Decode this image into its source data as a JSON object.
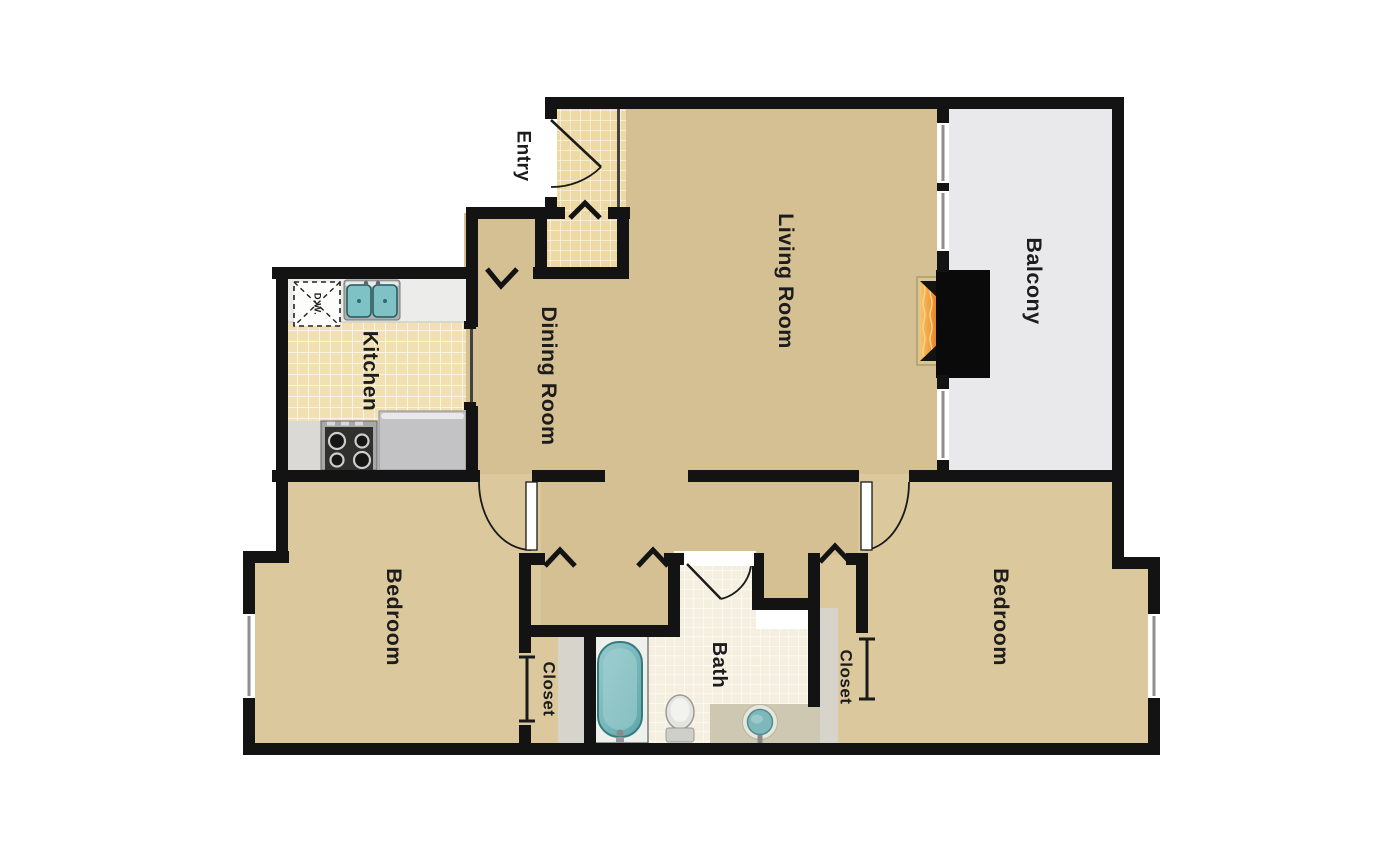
{
  "rooms": {
    "entry": "Entry",
    "living_room": "Living Room",
    "dining_room": "Dining Room",
    "kitchen": "Kitchen",
    "balcony": "Balcony",
    "bedroom_left": "Bedroom",
    "bedroom_right": "Bedroom",
    "closet_left": "Closet",
    "closet_right": "Closet",
    "bath": "Bath"
  },
  "appliances": {
    "dishwasher": "D.W."
  },
  "colors": {
    "wall": "#131313",
    "carpet": "#d5c094",
    "bedroom_carpet": "#dbc89d",
    "entry_tile": "#ecd9a4",
    "kitchen_tile": "#f0e0b2",
    "bath_tile": "#f5efdf",
    "balcony_floor": "#e9e9eb",
    "counter": "#ececea",
    "tub_teal": "#74b5b9",
    "sink_teal": "#7fc2c6",
    "fireplace_orange": "#e98f2e",
    "background": "#ffffff"
  }
}
